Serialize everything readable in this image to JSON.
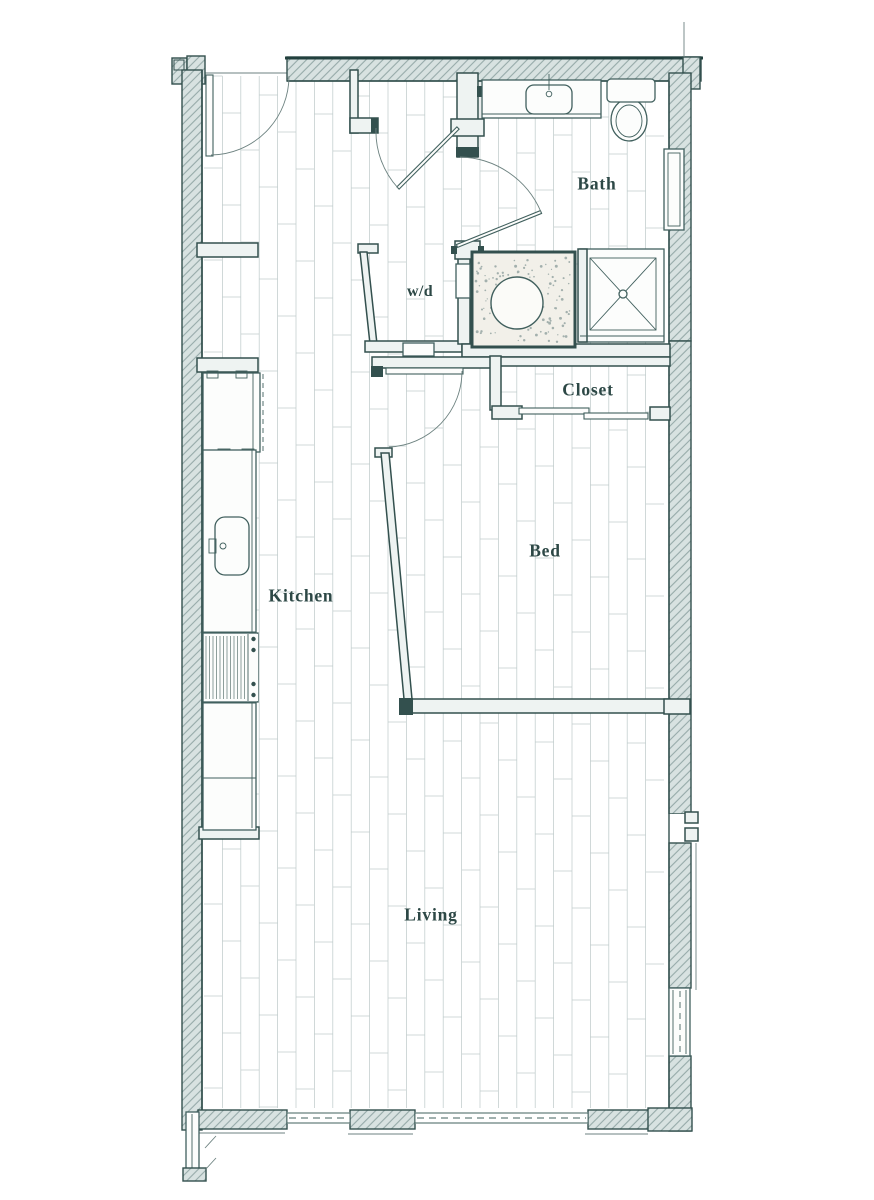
{
  "rooms": {
    "bath": "Bath",
    "wd": "w/d",
    "closet": "Closet",
    "bed": "Bed",
    "kitchen": "Kitchen",
    "living": "Living"
  },
  "fixtures": [
    "entry-door",
    "vanity-sink",
    "toilet",
    "bath-window",
    "shower",
    "soaking-tub",
    "washer-dryer-closet",
    "closet-sliding-doors",
    "refrigerator",
    "kitchen-counter",
    "kitchen-sink",
    "range",
    "bottom-window-left",
    "bottom-window-right",
    "side-window"
  ],
  "colors": {
    "paper": "#ffffff",
    "wall_stroke": "#33504e",
    "wall_fill": "#eef3f2",
    "hatch_bg": "#d8e2e1",
    "hatch_line": "#96aaa9",
    "plank_line": "#c0cccc",
    "label_text": "#2d4846",
    "fixture_stroke": "#41605e",
    "thin_line": "#6d8280",
    "speckle": "#a3b0ad"
  }
}
